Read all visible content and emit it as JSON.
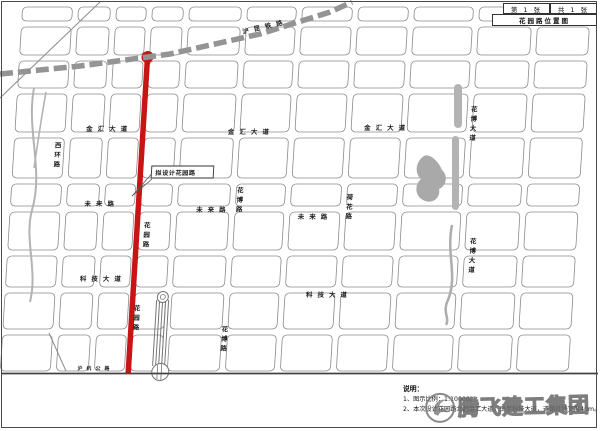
{
  "titleblock": {
    "sheet_no": "第 1 张",
    "sheet_total": "共 1 张",
    "title": "花园路位置图"
  },
  "callout": {
    "text": "拟设计花园路"
  },
  "roads": {
    "jinhui": "金汇大道",
    "weilai": "未来路",
    "keji": "科技大道",
    "huayuan": "花园路",
    "huabo": "花博大道",
    "xihuan": "西环路",
    "hehua": "荷花路",
    "huabolu": "花博路",
    "railway": "沪昆铁路",
    "bottom_road": "沪杭公路"
  },
  "notes": {
    "heading": "说明：",
    "line1": "1、图示比例：1:10000。",
    "line2": "2、本次设计花园路北起金汇大道，南至科技大道，道路红线宽度40m。"
  },
  "watermark": {
    "text": "腾飞建工集团"
  },
  "colors": {
    "route": "#c81414",
    "road_line": "#8a8a8a",
    "rail": "#949494",
    "water": "#b3b3b3",
    "border": "#4a4a4a"
  }
}
